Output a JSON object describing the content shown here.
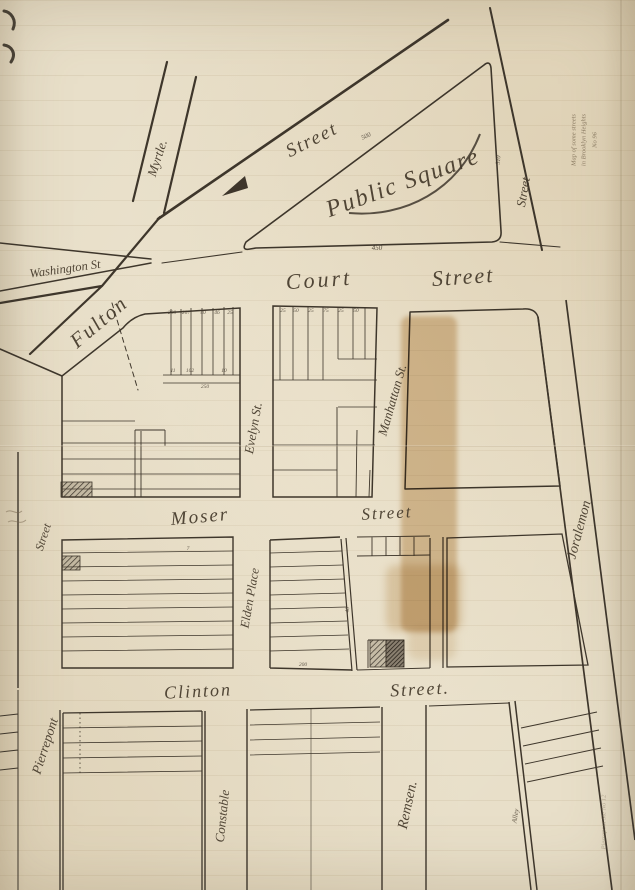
{
  "labels": {
    "myrtle": "Myrtle.",
    "washington": "Washington St",
    "fulton": "Fulton",
    "street_upper": "Street",
    "public_square": "Public Square",
    "court": "Court",
    "court_street": "Street",
    "street_right": "Street",
    "manhattan": "Manhattan St.",
    "evelyn": "Evelyn St.",
    "moser": "Moser",
    "moser_street": "Street",
    "elden_place": "Elden Place",
    "clinton": "Clinton",
    "clinton_street": "Street.",
    "joralemon": "Joralemon",
    "street_left": "Street",
    "pierrepont": "Pierrepont",
    "constable": "Constable",
    "remsen": "Remsen.",
    "alley": "Alley"
  },
  "dimensions": {
    "fulton_side": "500",
    "square_base": "450",
    "square_right": "310"
  },
  "lot_numbers": [
    "200",
    "207",
    "40",
    "46",
    "25",
    "11",
    "102",
    "10",
    "25",
    "50",
    "25",
    "75",
    "25",
    "50",
    "7",
    "200",
    "40",
    "250"
  ],
  "annotations": {
    "pencil_note_1": "Map of some streets",
    "pencil_note_2": "in Brooklyn Heights",
    "pencil_note_3": "No 96",
    "docket": "Pierrepont  Ste  No 12"
  },
  "colors": {
    "paper": "#e8dfc9",
    "ink": "#3e362b",
    "stain": "#c49a5d",
    "pencil": "#7d6f58"
  }
}
